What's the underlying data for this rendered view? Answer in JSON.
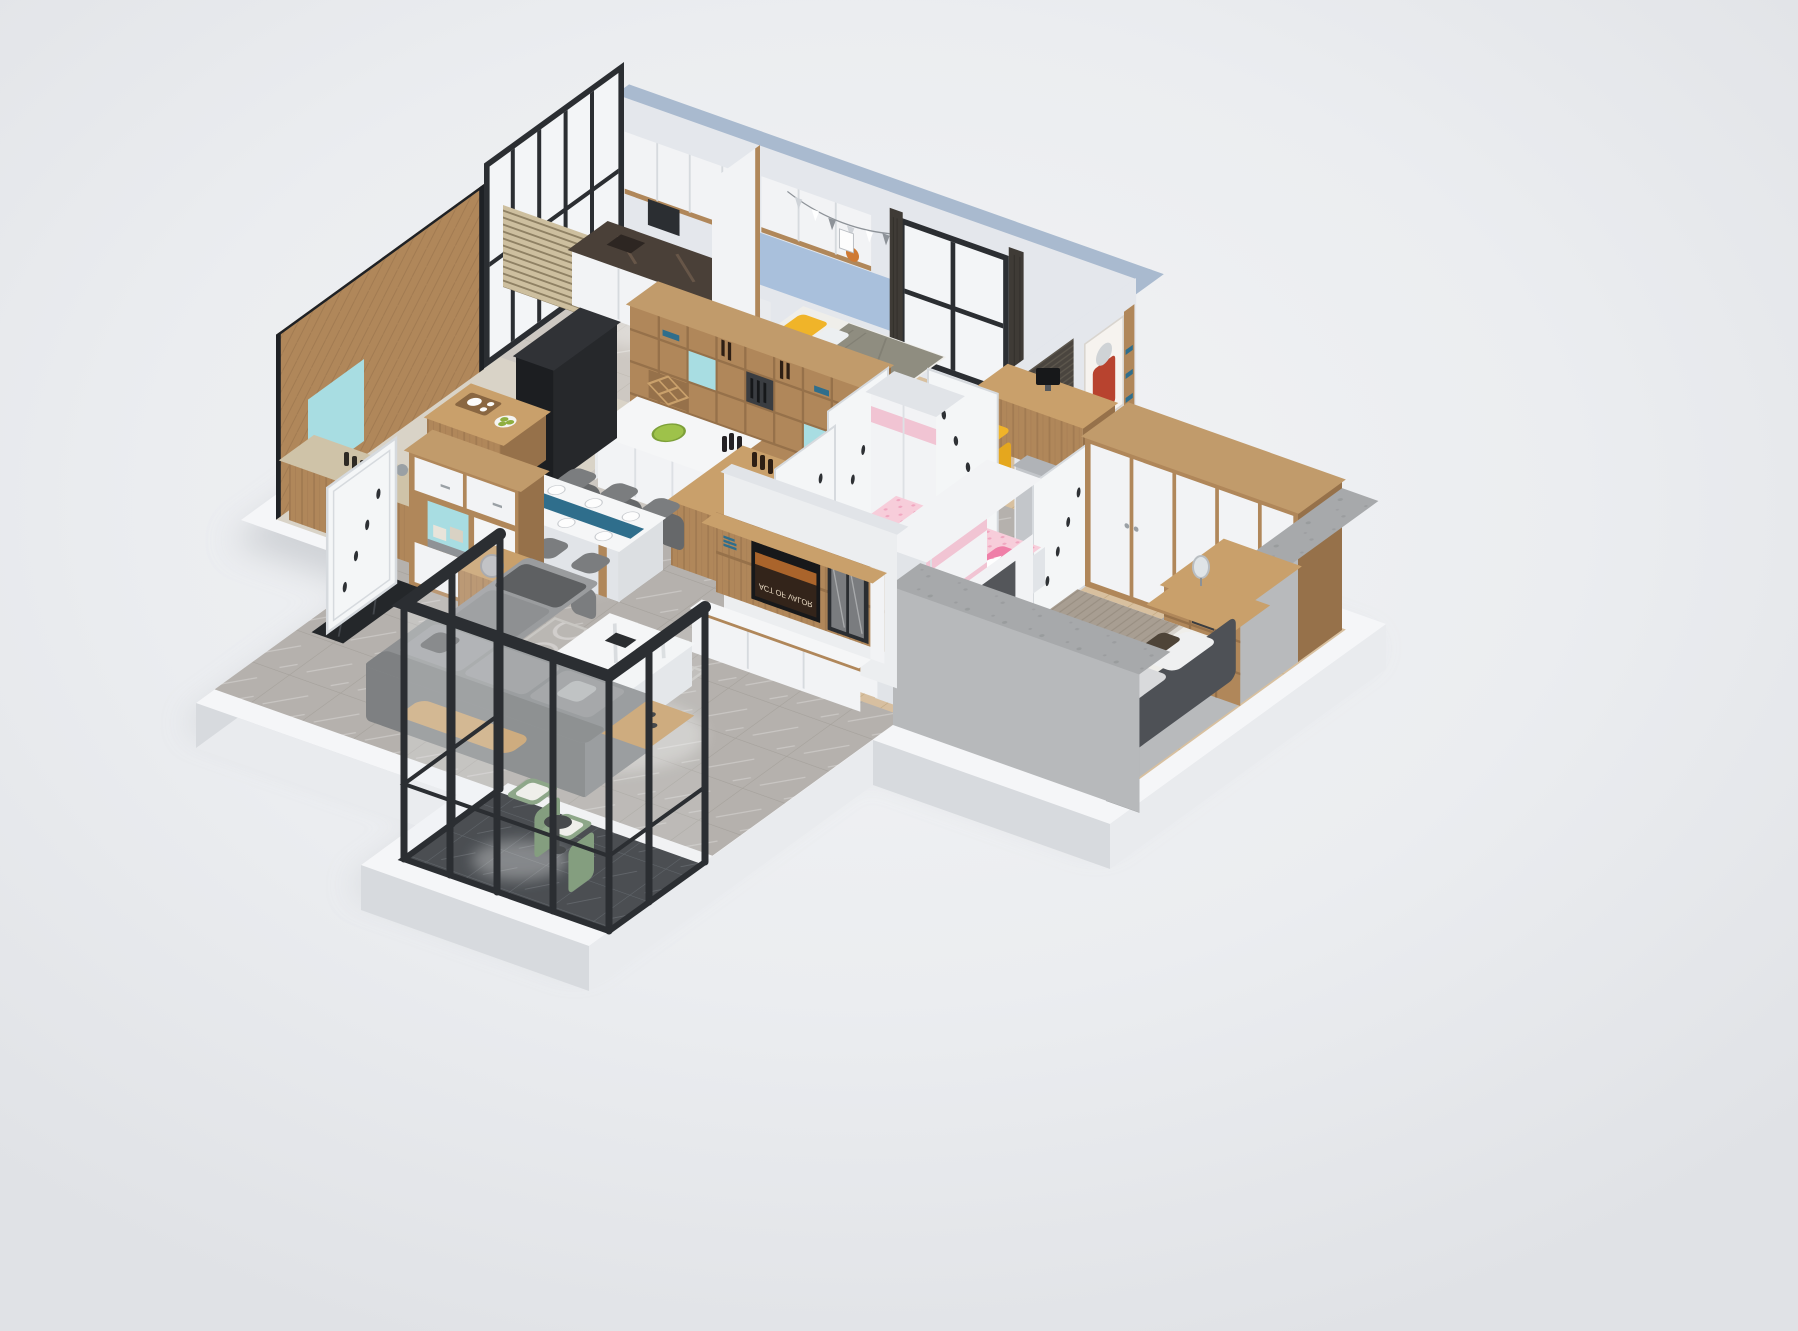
{
  "scene": {
    "type": "3d-isometric-apartment-render",
    "style": "cutaway dollhouse view of a full apartment on a white floor slab",
    "background": "plain light-gray studio backdrop, no text visible",
    "tv": {
      "poster_title": "ACT OF VALOR"
    }
  },
  "colors": {
    "bg_top": "#f2f3f5",
    "bg_mid": "#ebedf0",
    "bg_bottom": "#e0e2e6",
    "slab_top": "#f5f6f8",
    "slab_side": "#e9ebee",
    "slab_edge": "#d7dade",
    "drop_shadow": "#c6c9ce",
    "wall_blue_cap": "#a9bacf",
    "wall_inner": "#e4e7ec",
    "wall_blue_panel": "#a9c0dc",
    "frame_black": "#2b2e32",
    "glass": "#f3f5f7",
    "wood": "#b0875a",
    "wood_dark": "#96714a",
    "wood_light": "#c9a06b",
    "wood_cap": "#c19b6b",
    "cab_white": "#f2f3f5",
    "cab_white_shade": "#e1e4e8",
    "teal": "#a8dde2",
    "yellow": "#f0b429",
    "duvet_gray": "#8f8d80",
    "sheet_white": "#efeeea",
    "tile_gray": "#b5b1ad",
    "tile_line": "#9a958f",
    "tile_light": "#cdc8c2",
    "beige_floor": "#d9d3c7",
    "stone_top": "#cfc3a8",
    "marble_dark": "#4a4038",
    "marble_dark_vein": "#6f5c4c",
    "navy_runner": "#2f6e8c",
    "chair_gray": "#7b7d7f",
    "chair_gray_dark": "#66686a",
    "sofa": "#8e9092",
    "sofa_dark": "#7e8082",
    "sofa_light": "#9a9c9e",
    "pillow_dark": "#5e6062",
    "marble_white": "#f5f6f7",
    "marble_vein": "#d9dcdf",
    "pink": "#f7cdda",
    "pink_band": "#f1c4d3",
    "pink_chair": "#ef7fa8",
    "plank": "#d8c09f",
    "plank_line": "#c2a87f",
    "blanket_taupe": "#a89e92",
    "headboard_gray": "#4e5156",
    "concrete": "#a7a9ab",
    "concrete_dot": "#909294",
    "black_tile": "#2f3237",
    "black_tile_line": "#4b4f55",
    "balcony_green": "#7e9a77",
    "balcony_green_dark": "#73906c",
    "cream_cushion": "#f0efe9",
    "rug_base": "#bab7b3",
    "rug_ring": "#d5d3d0",
    "dark_cabinet": "#26282b",
    "curtain": "#3f3b36",
    "blind": "#4a453f",
    "door_white": "#f4f6f7",
    "door_edge": "#d6dade",
    "petal": "#2e3135",
    "frame_white": "#e9ebee",
    "frame_inner": "#c7ccd1",
    "tv_black": "#17181a",
    "poster_warm": "#c8742f",
    "hall_wall_gray": "#c3c6ca",
    "light_pool": "#ffffff"
  },
  "rooms": [
    {
      "name": "kids-bedroom",
      "area": "top",
      "contents": [
        "bed-with-yellow-pillows",
        "gray-duvet",
        "blue-headboard-panel",
        "wall-bunting",
        "window-with-dark-curtains",
        "overhead-white-cabinets"
      ]
    },
    {
      "name": "study-bedroom",
      "area": "top-right",
      "contents": [
        "wood-desk",
        "yellow-chair",
        "monitor",
        "rhino-poster",
        "dark-roller-blind",
        "bookshelf"
      ]
    },
    {
      "name": "laundry-corner",
      "area": "top-left",
      "contents": [
        "washing-machine",
        "dark-marble-counter",
        "white-upper-cabinets"
      ]
    },
    {
      "name": "kitchen-bar",
      "area": "center-left",
      "contents": [
        "wine-shelf-unit-with-teal-niches",
        "white-island-counter",
        "wine-bottles",
        "wood-bar-counter"
      ]
    },
    {
      "name": "tea-room",
      "area": "left",
      "contents": [
        "herringbone-wood-walls",
        "wood-slat-screen",
        "tea-table-with-tea-set",
        "black-cabinet",
        "teal-accent-panel",
        "stone-top-counter-with-bottles"
      ]
    },
    {
      "name": "dining-room",
      "area": "center-left",
      "contents": [
        "white-marble-table",
        "blue-table-runner",
        "place-settings",
        "six-gray-chairs"
      ]
    },
    {
      "name": "entry",
      "area": "lower-left",
      "contents": [
        "shoe-cabinet-with-teal-niches",
        "white-entry-door",
        "black-marble-threshold"
      ]
    },
    {
      "name": "hallway",
      "area": "center",
      "contents": [
        "white-doors-with-petal-decals",
        "gray-marble-floor"
      ]
    },
    {
      "name": "pink-kids-bedroom",
      "area": "center",
      "contents": [
        "pink-hello-kitty-bed",
        "pink-white-wardrobe",
        "white-desk",
        "pink-chair"
      ]
    },
    {
      "name": "living-room",
      "area": "bottom-center",
      "contents": [
        "gray-sectional-sofa",
        "chaise-lounge",
        "white-marble-coffee-table",
        "tv-wall-unit",
        "glass-display-cabinet",
        "wood-side-tables",
        "floor-lamp",
        "circle-pattern-rug"
      ]
    },
    {
      "name": "master-bedroom",
      "area": "right",
      "contents": [
        "double-bed-gray-bedding",
        "dark-upholstered-headboard",
        "white-door-wardrobe",
        "dressing-corner-with-mirror",
        "ribbed-white-stool",
        "white-tv-cabinet",
        "concrete-cutaway-walls",
        "light-wood-floor",
        "gray-rug"
      ]
    },
    {
      "name": "balcony",
      "area": "bottom-right",
      "contents": [
        "black-metal-glass-frame",
        "two-green-armchairs",
        "round-black-side-table",
        "black-marble-tile-floor"
      ]
    }
  ]
}
